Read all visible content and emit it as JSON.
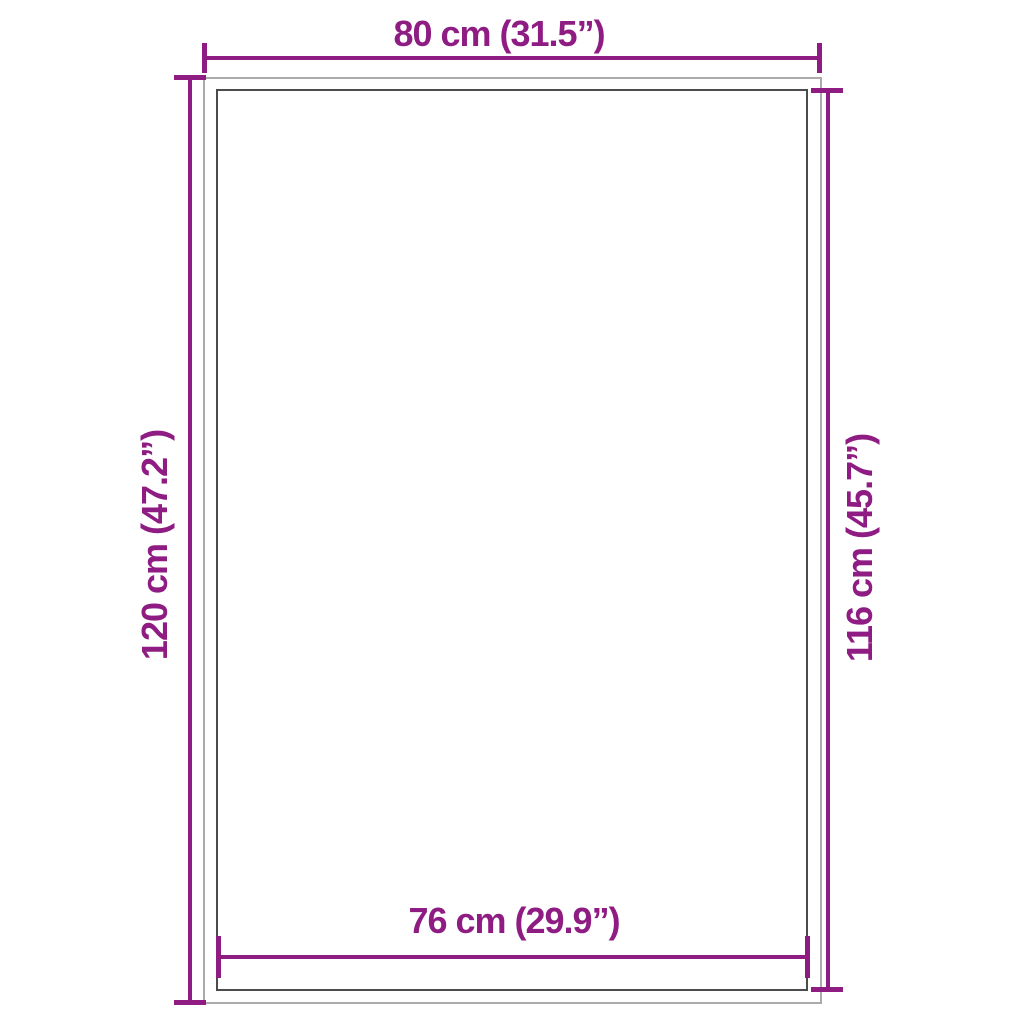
{
  "diagram": {
    "kind": "product-dimension-diagram",
    "colors": {
      "background": "#ffffff",
      "accent": "#8e1c82",
      "outer_outline": "#ababab",
      "inner_outline": "#4c4c4c"
    },
    "labels": {
      "top": "80 cm (31.5”)",
      "left": "120 cm (47.2”)",
      "right": "116 cm (45.7”)",
      "bottom": "76 cm (29.9”)"
    }
  }
}
